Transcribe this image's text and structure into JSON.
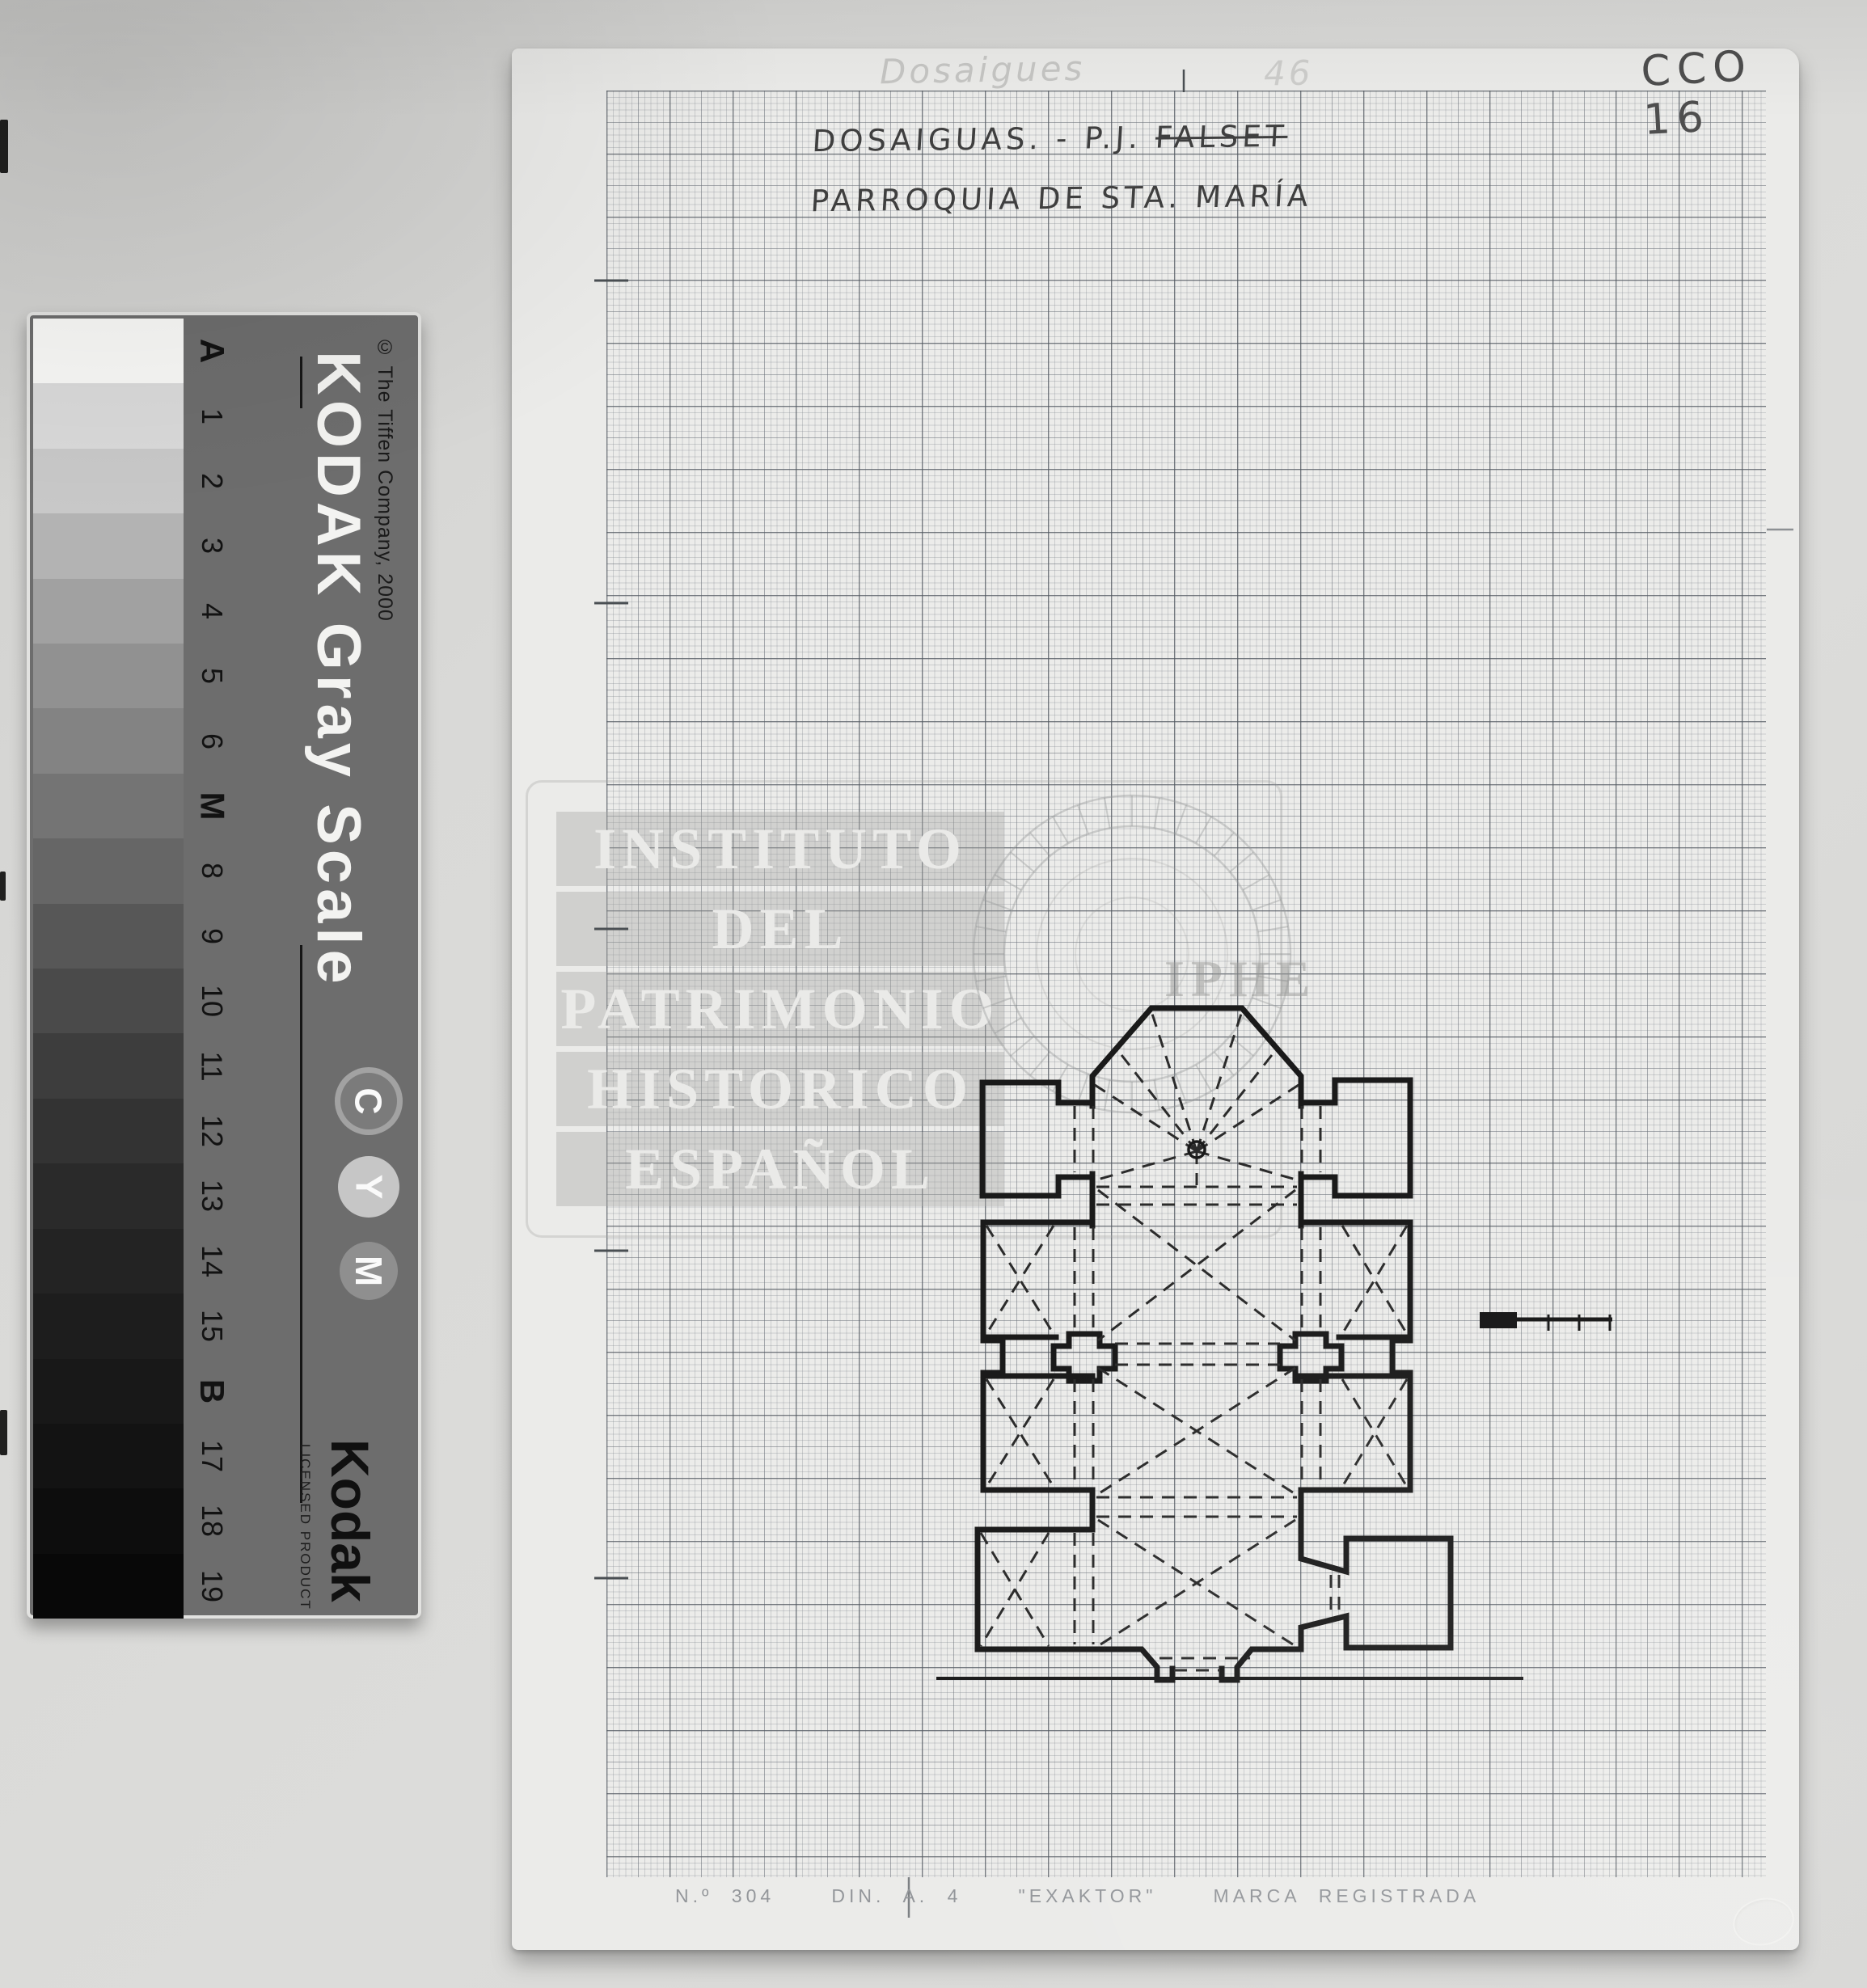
{
  "page": {
    "code_top_right": "CCO 16",
    "pencil_note_left": "Dosaigues",
    "pencil_note_right": "46"
  },
  "sheet": {
    "title_line1_prefix": "DOSAIGUAS. - P.J. ",
    "title_line1_struck": "FALSET",
    "title_line2": "PARROQUIA DE STA. MARÍA",
    "footer": "N.º 304   DIN. A. 4   \"EXAKTOR\"   MARCA REGISTRADA"
  },
  "watermark": {
    "lines": [
      "INSTITUTO",
      "DEL",
      "PATRIMONIO",
      "HISTORICO",
      "ESPAÑOL"
    ],
    "seal_text": "IPHE"
  },
  "gray_card": {
    "title": "KODAK Gray Scale",
    "copyright": "© The Tiffen Company, 2000",
    "logo": "Kodak",
    "license": "LICENSED PRODUCT",
    "cym": [
      "C",
      "Y",
      "M"
    ],
    "steps": [
      {
        "label": "A",
        "color": "#f8f8f6",
        "bold": true
      },
      {
        "label": "1",
        "color": "#d9d9d9"
      },
      {
        "label": "2",
        "color": "#c8c8c8"
      },
      {
        "label": "3",
        "color": "#b3b3b3"
      },
      {
        "label": "4",
        "color": "#a1a1a1"
      },
      {
        "label": "5",
        "color": "#919191"
      },
      {
        "label": "6",
        "color": "#838383"
      },
      {
        "label": "M",
        "color": "#747474",
        "bold": true
      },
      {
        "label": "8",
        "color": "#666666"
      },
      {
        "label": "9",
        "color": "#575757"
      },
      {
        "label": "10",
        "color": "#4a4a4a"
      },
      {
        "label": "11",
        "color": "#3d3d3d"
      },
      {
        "label": "12",
        "color": "#333333"
      },
      {
        "label": "13",
        "color": "#2a2a2a"
      },
      {
        "label": "14",
        "color": "#232323"
      },
      {
        "label": "15",
        "color": "#1d1d1d"
      },
      {
        "label": "B",
        "color": "#181818",
        "bold": true
      },
      {
        "label": "17",
        "color": "#131313"
      },
      {
        "label": "18",
        "color": "#0d0d0d"
      },
      {
        "label": "19",
        "color": "#080808"
      }
    ]
  }
}
